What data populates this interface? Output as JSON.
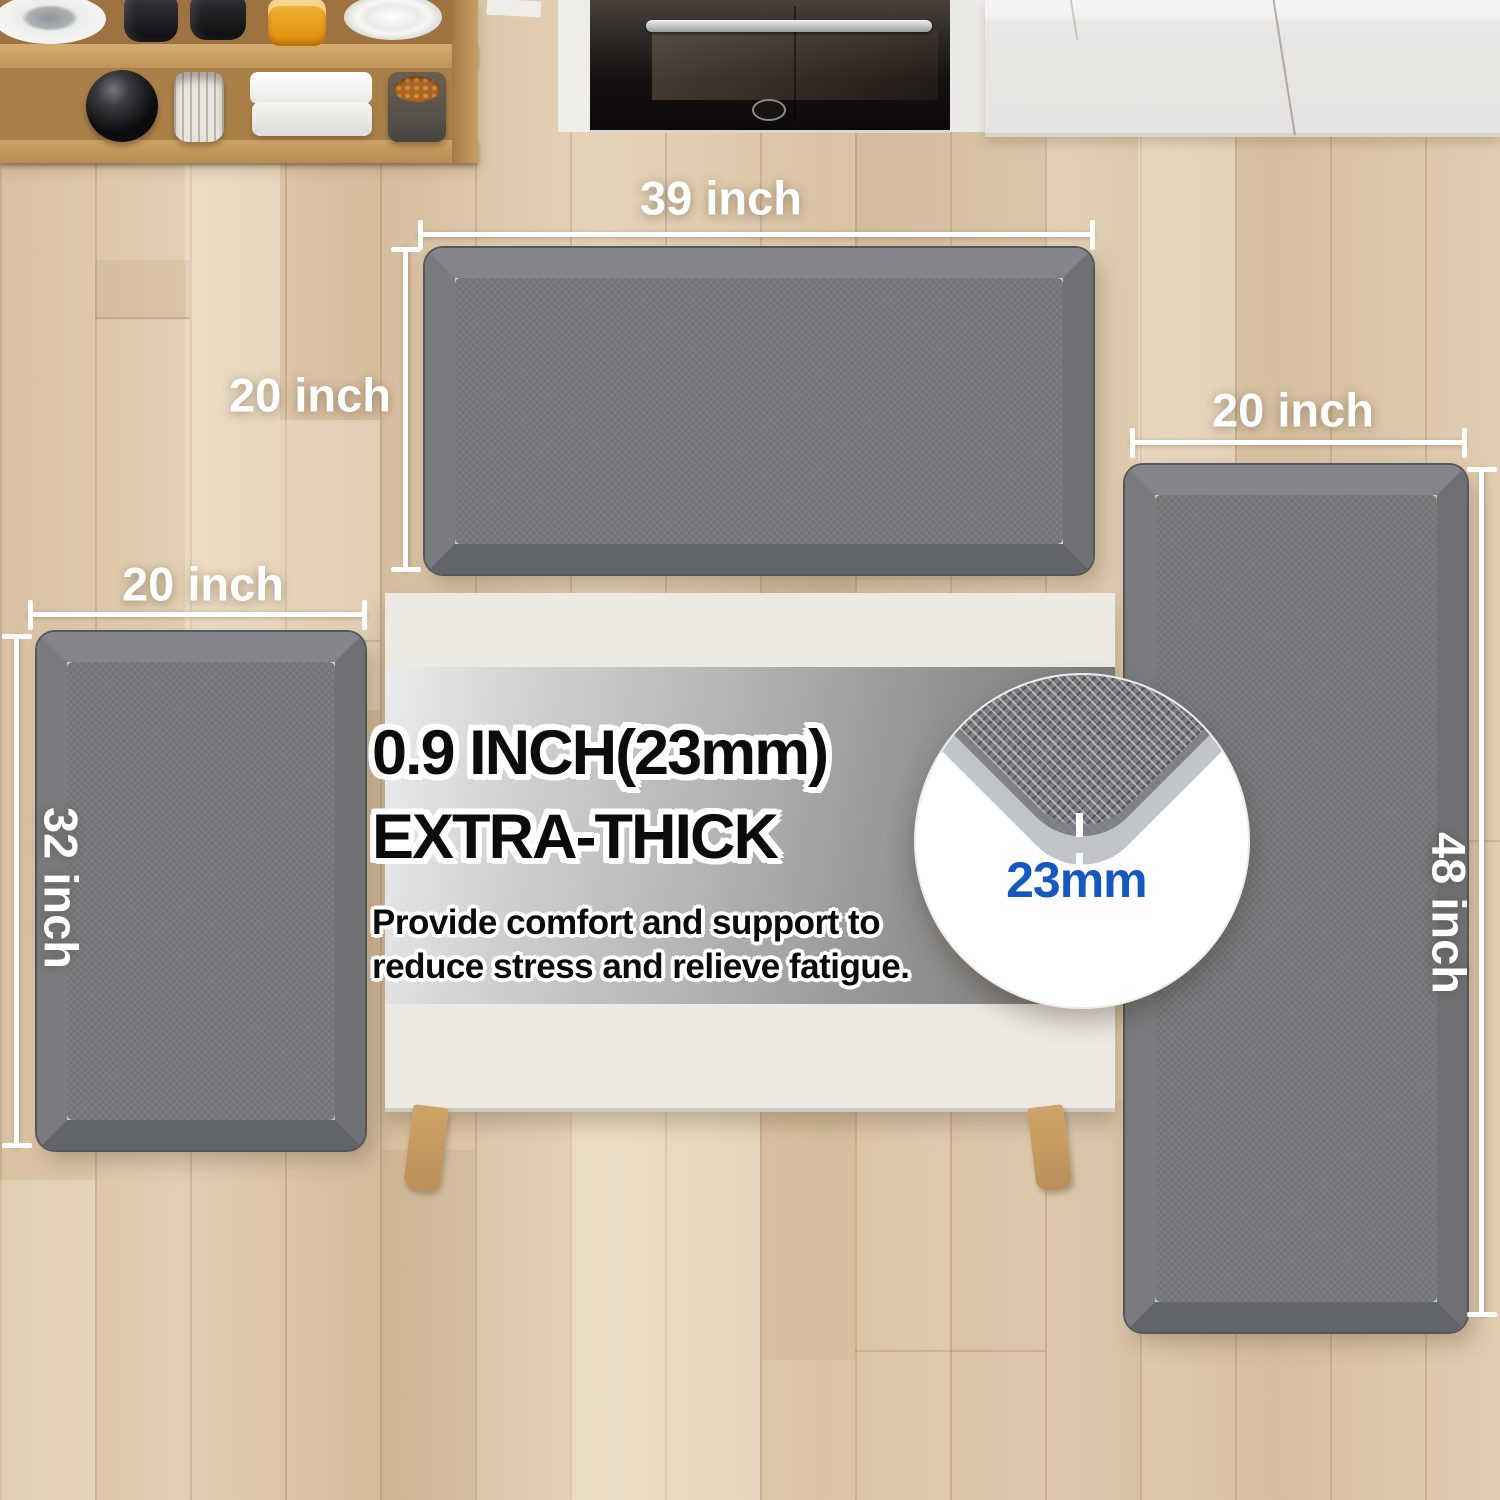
{
  "dimensions": {
    "top_mat_width": "39 inch",
    "top_mat_depth": "20 inch",
    "left_mat_width": "20 inch",
    "left_mat_length": "32 inch",
    "right_mat_width": "20 inch",
    "right_mat_length": "48 inch"
  },
  "info_panel": {
    "heading_line1": "0.9 INCH(23mm)",
    "heading_line2": "EXTRA-THICK",
    "body_line1": "Provide comfort and support to",
    "body_line2": "reduce stress and relieve fatigue."
  },
  "zoom_callout": {
    "thickness_label": "23mm"
  },
  "colors": {
    "accent_blue": "#1558bf",
    "mat_gray": "#76787c",
    "floor_wood": "#ddc6a8",
    "shelf_wood": "#ab8049",
    "table_top": "#edeae4",
    "annotation": "#ffffff"
  }
}
